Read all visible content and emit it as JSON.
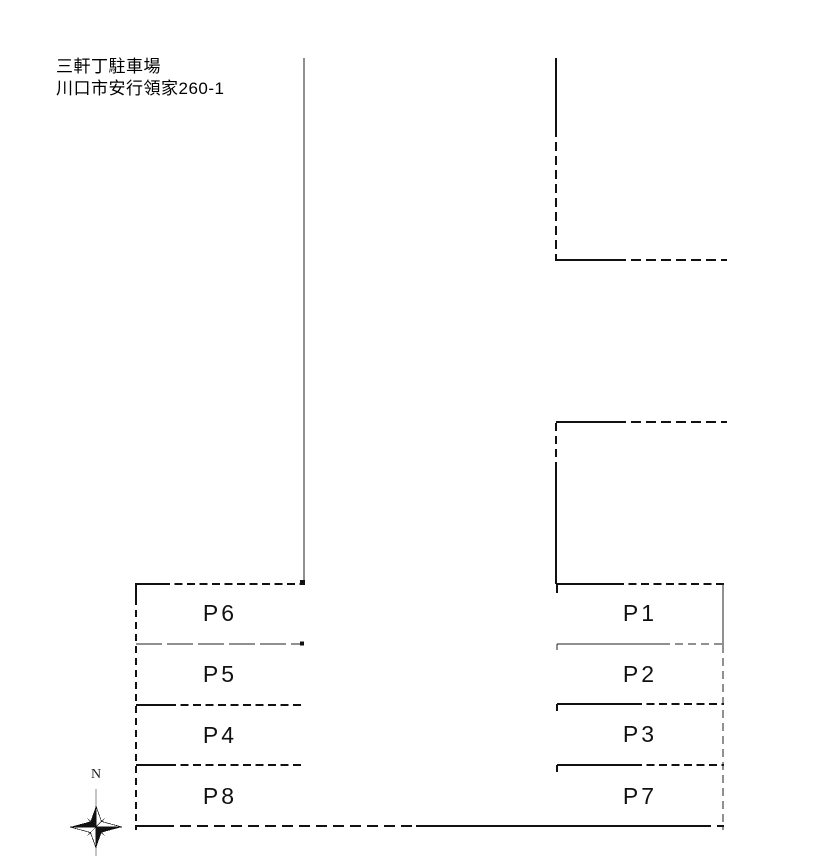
{
  "header": {
    "title": "三軒丁駐車場",
    "address": "川口市安行領家260-1"
  },
  "compass": {
    "north_label": "N"
  },
  "stalls": {
    "left": [
      {
        "label": "P6"
      },
      {
        "label": "P5"
      },
      {
        "label": "P4"
      },
      {
        "label": "P8"
      }
    ],
    "right": [
      {
        "label": "P1"
      },
      {
        "label": "P2"
      },
      {
        "label": "P3"
      },
      {
        "label": "P7"
      }
    ]
  },
  "colors": {
    "line": "#1a1a1a",
    "text": "#000000",
    "background": "#ffffff"
  }
}
